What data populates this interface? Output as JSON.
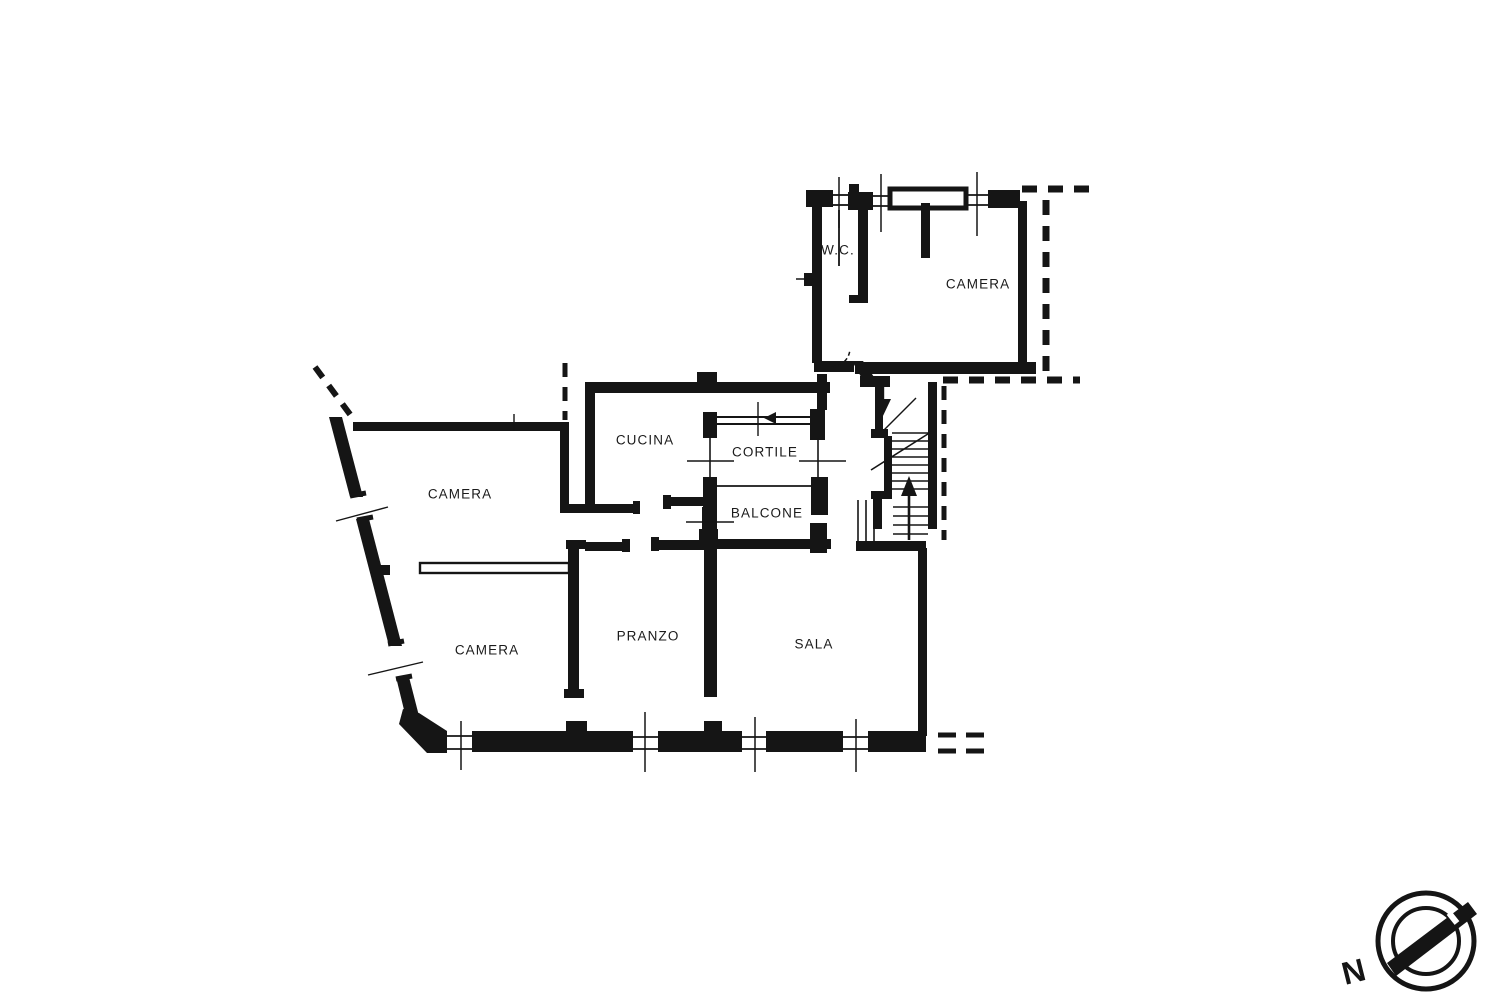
{
  "document": {
    "type": "floor-plan"
  },
  "rooms": [
    {
      "id": "wc",
      "label": "W.C.",
      "x": 838,
      "y": 250
    },
    {
      "id": "camera-ne",
      "label": "CAMERA",
      "x": 978,
      "y": 284
    },
    {
      "id": "cucina",
      "label": "CUCINA",
      "x": 645,
      "y": 440
    },
    {
      "id": "cortile",
      "label": "CORTILE",
      "x": 765,
      "y": 452
    },
    {
      "id": "balcone",
      "label": "BALCONE",
      "x": 767,
      "y": 513
    },
    {
      "id": "camera-w",
      "label": "CAMERA",
      "x": 460,
      "y": 494
    },
    {
      "id": "camera-sw",
      "label": "CAMERA",
      "x": 487,
      "y": 650
    },
    {
      "id": "pranzo",
      "label": "PRANZO",
      "x": 648,
      "y": 636
    },
    {
      "id": "sala",
      "label": "SALA",
      "x": 814,
      "y": 644
    }
  ],
  "compass": {
    "label": "N"
  },
  "colors": {
    "ink": "#151515",
    "paper": "#ffffff"
  }
}
